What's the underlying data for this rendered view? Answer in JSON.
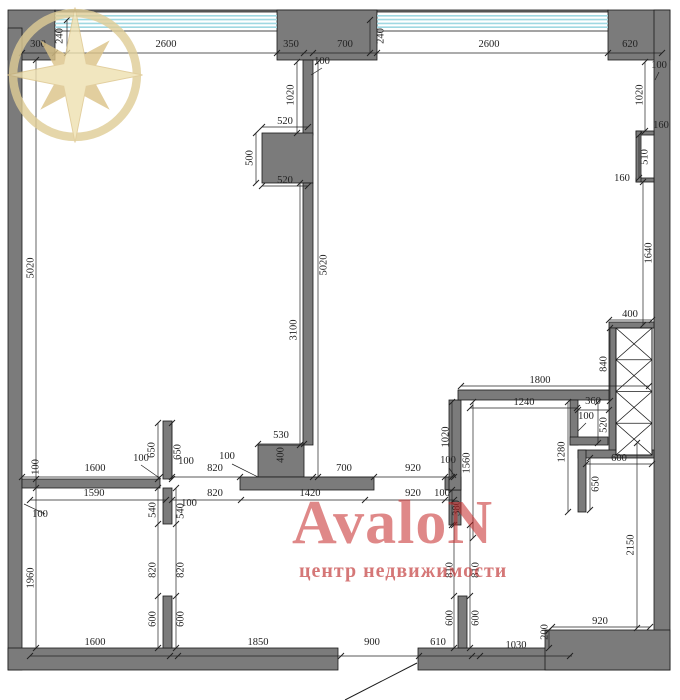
{
  "watermark": {
    "brand": "AvaloN",
    "tagline": "центр недвижимости",
    "brand_color": "#c62828",
    "tagline_color": "#c03030",
    "star_fill": "#eee0b0",
    "star_dark": "#dbc387",
    "star_ring": "#dfcd96"
  },
  "plan": {
    "wall_color": "#7b7b7b",
    "line_color": "#1a1a1a",
    "dim_color": "#222222",
    "glass_color": "#9fd8e2",
    "walls": [
      [
        8,
        10,
        47,
        50
      ],
      [
        55,
        10,
        553,
        9
      ],
      [
        277,
        10,
        100,
        50
      ],
      [
        608,
        10,
        62,
        50
      ],
      [
        8,
        28,
        14,
        642
      ],
      [
        654,
        10,
        16,
        660
      ],
      [
        8,
        648,
        330,
        22
      ],
      [
        418,
        648,
        252,
        22
      ],
      [
        545,
        630,
        125,
        40
      ],
      [
        303,
        60,
        10,
        75
      ],
      [
        262,
        133,
        51,
        50
      ],
      [
        303,
        183,
        10,
        262
      ],
      [
        258,
        445,
        46,
        32
      ],
      [
        240,
        477,
        134,
        13
      ],
      [
        22,
        479,
        138,
        9
      ],
      [
        163,
        421,
        9,
        58
      ],
      [
        163,
        488,
        9,
        36
      ],
      [
        163,
        596,
        9,
        52
      ],
      [
        445,
        477,
        16,
        13
      ],
      [
        449,
        490,
        12,
        35
      ],
      [
        449,
        400,
        12,
        90
      ],
      [
        458,
        596,
        9,
        52
      ],
      [
        458,
        390,
        155,
        10
      ],
      [
        570,
        400,
        8,
        45
      ],
      [
        570,
        437,
        38,
        8
      ],
      [
        609,
        322,
        45,
        6
      ],
      [
        609,
        328,
        7,
        127
      ],
      [
        578,
        450,
        76,
        8
      ],
      [
        578,
        450,
        8,
        62
      ],
      [
        636,
        131,
        18,
        4
      ],
      [
        636,
        178,
        18,
        4
      ],
      [
        636,
        131,
        5,
        51
      ]
    ],
    "windows": [
      [
        55,
        12,
        222,
        19
      ],
      [
        377,
        12,
        231,
        19
      ]
    ],
    "shaft": {
      "x": 616,
      "y": 328,
      "w": 36,
      "h": 127,
      "cells": 4
    },
    "door_swing": [
      417,
      663,
      345,
      700
    ],
    "leaders": [
      [
        322,
        68,
        311,
        75
      ],
      [
        232,
        464,
        258,
        477
      ],
      [
        45,
        514,
        24,
        504
      ],
      [
        449,
        468,
        456,
        478
      ],
      [
        141,
        465,
        161,
        479
      ],
      [
        586,
        423,
        578,
        431
      ],
      [
        659,
        72,
        655,
        80
      ]
    ],
    "dim_lines": [
      {
        "p": [
          22,
          53,
          662,
          53
        ],
        "t": [
          [
            22,
            53
          ],
          [
            55,
            53
          ],
          [
            277,
            53
          ],
          [
            304,
            53
          ],
          [
            313,
            53
          ],
          [
            377,
            53
          ],
          [
            608,
            53
          ],
          [
            662,
            53
          ]
        ]
      },
      {
        "p": [
          36,
          60,
          36,
          648
        ],
        "t": [
          [
            36,
            60
          ],
          [
            36,
            479
          ],
          [
            36,
            488
          ],
          [
            36,
            648
          ]
        ]
      },
      {
        "p": [
          67,
          20,
          67,
          53
        ],
        "t": [
          [
            67,
            20
          ],
          [
            67,
            53
          ]
        ]
      },
      {
        "p": [
          370,
          20,
          370,
          53
        ],
        "t": [
          [
            370,
            20
          ],
          [
            370,
            53
          ]
        ]
      },
      {
        "p": [
          30,
          656,
          572,
          656
        ],
        "t": [
          [
            30,
            656
          ],
          [
            170,
            656
          ],
          [
            178,
            656
          ],
          [
            341,
            656
          ],
          [
            419,
            656
          ],
          [
            472,
            656
          ],
          [
            480,
            656
          ],
          [
            570,
            656
          ]
        ]
      },
      {
        "p": [
          645,
          62,
          645,
          131
        ],
        "t": [
          [
            645,
            62
          ],
          [
            645,
            131
          ]
        ]
      },
      {
        "p": [
          639,
          135,
          639,
          178
        ],
        "t": [
          [
            639,
            135
          ],
          [
            639,
            178
          ]
        ]
      },
      {
        "p": [
          643,
          182,
          643,
          325
        ],
        "t": [
          [
            643,
            182
          ],
          [
            643,
            325
          ]
        ]
      },
      {
        "p": [
          609,
          320,
          652,
          320
        ],
        "t": [
          [
            609,
            320
          ],
          [
            652,
            320
          ]
        ]
      },
      {
        "p": [
          610,
          328,
          610,
          401
        ],
        "t": [
          [
            610,
            328
          ],
          [
            610,
            401
          ]
        ]
      },
      {
        "p": [
          461,
          386,
          649,
          386
        ],
        "t": [
          [
            461,
            386
          ],
          [
            649,
            386
          ]
        ]
      },
      {
        "p": [
          470,
          408,
          577,
          408
        ],
        "t": [
          [
            470,
            408
          ],
          [
            577,
            408
          ]
        ]
      },
      {
        "p": [
          578,
          410,
          609,
          410
        ],
        "t": [
          [
            578,
            410
          ],
          [
            609,
            410
          ]
        ]
      },
      {
        "p": [
          598,
          402,
          598,
          443
        ],
        "t": [
          [
            598,
            402
          ],
          [
            598,
            443
          ]
        ]
      },
      {
        "p": [
          452,
          402,
          452,
          477
        ],
        "t": [
          [
            452,
            402
          ],
          [
            452,
            477
          ]
        ]
      },
      {
        "p": [
          473,
          402,
          473,
          538
        ],
        "t": [
          [
            473,
            402
          ],
          [
            473,
            538
          ]
        ]
      },
      {
        "p": [
          568,
          402,
          568,
          512
        ],
        "t": [
          [
            568,
            402
          ],
          [
            568,
            512
          ]
        ]
      },
      {
        "p": [
          586,
          464,
          652,
          464
        ],
        "t": [
          [
            586,
            464
          ],
          [
            652,
            464
          ]
        ]
      },
      {
        "p": [
          590,
          458,
          590,
          510
        ],
        "t": [
          [
            590,
            458
          ],
          [
            590,
            510
          ]
        ]
      },
      {
        "p": [
          22,
          477,
          160,
          477
        ],
        "t": [
          [
            22,
            477
          ],
          [
            160,
            477
          ]
        ]
      },
      {
        "p": [
          172,
          477,
          240,
          477
        ],
        "t": [
          [
            172,
            477
          ],
          [
            240,
            477
          ]
        ]
      },
      {
        "p": [
          313,
          477,
          454,
          477
        ],
        "t": [
          [
            313,
            477
          ],
          [
            374,
            477
          ],
          [
            445,
            477
          ],
          [
            454,
            477
          ]
        ]
      },
      {
        "p": [
          30,
          500,
          166,
          500
        ],
        "t": [
          [
            30,
            500
          ],
          [
            166,
            500
          ]
        ]
      },
      {
        "p": [
          172,
          500,
          454,
          500
        ],
        "t": [
          [
            172,
            500
          ],
          [
            241,
            500
          ],
          [
            365,
            500
          ],
          [
            445,
            500
          ],
          [
            454,
            500
          ]
        ]
      },
      {
        "p": [
          258,
          444,
          304,
          444
        ],
        "t": [
          [
            258,
            444
          ],
          [
            304,
            444
          ]
        ]
      },
      {
        "p": [
          262,
          127,
          308,
          127
        ],
        "t": [
          [
            262,
            127
          ],
          [
            308,
            127
          ]
        ]
      },
      {
        "p": [
          256,
          133,
          256,
          183
        ],
        "t": [
          [
            256,
            133
          ],
          [
            256,
            183
          ]
        ]
      },
      {
        "p": [
          262,
          186,
          308,
          186
        ],
        "t": [
          [
            262,
            186
          ],
          [
            308,
            186
          ]
        ]
      },
      {
        "p": [
          297,
          62,
          297,
          133
        ],
        "t": [
          [
            297,
            62
          ],
          [
            297,
            133
          ]
        ]
      },
      {
        "p": [
          300,
          183,
          300,
          445
        ],
        "t": [
          [
            300,
            183
          ],
          [
            300,
            445
          ]
        ]
      },
      {
        "p": [
          318,
          62,
          318,
          477
        ],
        "t": [
          [
            318,
            62
          ],
          [
            318,
            477
          ]
        ]
      },
      {
        "p": [
          158,
          423,
          158,
          479
        ],
        "t": [
          [
            158,
            423
          ],
          [
            158,
            479
          ]
        ]
      },
      {
        "p": [
          172,
          423,
          172,
          479
        ],
        "t": [
          [
            172,
            423
          ],
          [
            172,
            479
          ]
        ]
      },
      {
        "p": [
          158,
          488,
          158,
          648
        ],
        "t": [
          [
            158,
            488
          ],
          [
            158,
            524
          ],
          [
            158,
            596
          ],
          [
            158,
            648
          ]
        ]
      },
      {
        "p": [
          176,
          488,
          176,
          648
        ],
        "t": [
          [
            176,
            488
          ],
          [
            176,
            524
          ],
          [
            176,
            596
          ],
          [
            176,
            648
          ]
        ]
      },
      {
        "p": [
          454,
          525,
          454,
          648
        ],
        "t": [
          [
            454,
            525
          ],
          [
            454,
            596
          ],
          [
            454,
            648
          ]
        ]
      },
      {
        "p": [
          470,
          525,
          470,
          648
        ],
        "t": [
          [
            470,
            525
          ],
          [
            470,
            596
          ],
          [
            470,
            648
          ]
        ]
      },
      {
        "p": [
          637,
          443,
          637,
          628
        ],
        "t": [
          [
            637,
            443
          ],
          [
            637,
            628
          ]
        ]
      },
      {
        "p": [
          552,
          627,
          650,
          627
        ],
        "t": [
          [
            552,
            627
          ],
          [
            650,
            627
          ]
        ]
      },
      {
        "p": [
          549,
          630,
          549,
          648
        ],
        "t": [
          [
            549,
            630
          ],
          [
            549,
            648
          ]
        ]
      },
      {
        "p": [
          452,
          490,
          452,
          525
        ],
        "t": [
          [
            452,
            490
          ],
          [
            452,
            525
          ]
        ]
      }
    ],
    "labels": [
      [
        "240",
        60,
        36,
        90
      ],
      [
        "300",
        38,
        47,
        0
      ],
      [
        "2600",
        166,
        47,
        0
      ],
      [
        "350",
        291,
        47,
        0
      ],
      [
        "700",
        345,
        47,
        0
      ],
      [
        "240",
        381,
        36,
        90
      ],
      [
        "2600",
        489,
        47,
        0
      ],
      [
        "620",
        630,
        47,
        0
      ],
      [
        "100",
        322,
        64,
        0
      ],
      [
        "100",
        659,
        68,
        0
      ],
      [
        "1020",
        291,
        95,
        90
      ],
      [
        "1020",
        640,
        95,
        90
      ],
      [
        "160",
        661,
        128,
        0
      ],
      [
        "510",
        645,
        157,
        90
      ],
      [
        "160",
        622,
        181,
        0
      ],
      [
        "520",
        285,
        124,
        0
      ],
      [
        "500",
        250,
        158,
        90
      ],
      [
        "520",
        285,
        183,
        0
      ],
      [
        "5020",
        31,
        268,
        90
      ],
      [
        "3100",
        294,
        330,
        90
      ],
      [
        "5020",
        324,
        265,
        90
      ],
      [
        "1640",
        649,
        253,
        90
      ],
      [
        "400",
        630,
        317,
        0
      ],
      [
        "840",
        604,
        364,
        90
      ],
      [
        "1800",
        540,
        383,
        0
      ],
      [
        "1240",
        524,
        405,
        0
      ],
      [
        "360",
        593,
        404,
        0
      ],
      [
        "100",
        586,
        419,
        0
      ],
      [
        "520",
        604,
        425,
        90
      ],
      [
        "1020",
        446,
        437,
        90
      ],
      [
        "1560",
        467,
        463,
        90
      ],
      [
        "1280",
        562,
        452,
        90
      ],
      [
        "600",
        619,
        461,
        0
      ],
      [
        "650",
        596,
        484,
        90
      ],
      [
        "100",
        36,
        467,
        90
      ],
      [
        "1600",
        95,
        471,
        0
      ],
      [
        "100",
        141,
        461,
        0
      ],
      [
        "650",
        152,
        450,
        90
      ],
      [
        "650",
        178,
        452,
        90
      ],
      [
        "100",
        186,
        464,
        0
      ],
      [
        "820",
        215,
        471,
        0
      ],
      [
        "100",
        227,
        459,
        0
      ],
      [
        "400",
        281,
        455,
        90
      ],
      [
        "530",
        281,
        438,
        0
      ],
      [
        "700",
        344,
        471,
        0
      ],
      [
        "920",
        413,
        471,
        0
      ],
      [
        "100",
        448,
        463,
        0
      ],
      [
        "1590",
        94,
        496,
        0
      ],
      [
        "820",
        215,
        496,
        0
      ],
      [
        "1420",
        310,
        496,
        0
      ],
      [
        "920",
        413,
        496,
        0
      ],
      [
        "100",
        442,
        496,
        0
      ],
      [
        "380",
        457,
        508,
        90
      ],
      [
        "100",
        40,
        517,
        0
      ],
      [
        "540",
        153,
        510,
        90
      ],
      [
        "540",
        181,
        511,
        90
      ],
      [
        "100",
        189,
        506,
        0
      ],
      [
        "1960",
        31,
        578,
        90
      ],
      [
        "820",
        153,
        570,
        90
      ],
      [
        "820",
        181,
        570,
        90
      ],
      [
        "600",
        153,
        619,
        90
      ],
      [
        "600",
        181,
        619,
        90
      ],
      [
        "810",
        450,
        570,
        90
      ],
      [
        "810",
        476,
        570,
        90
      ],
      [
        "600",
        450,
        618,
        90
      ],
      [
        "600",
        476,
        618,
        90
      ],
      [
        "2150",
        631,
        545,
        90
      ],
      [
        "1600",
        95,
        645,
        0
      ],
      [
        "1850",
        258,
        645,
        0
      ],
      [
        "900",
        372,
        645,
        0
      ],
      [
        "610",
        438,
        645,
        0
      ],
      [
        "1030",
        516,
        648,
        0
      ],
      [
        "200",
        545,
        632,
        90
      ],
      [
        "920",
        600,
        624,
        0
      ]
    ]
  }
}
